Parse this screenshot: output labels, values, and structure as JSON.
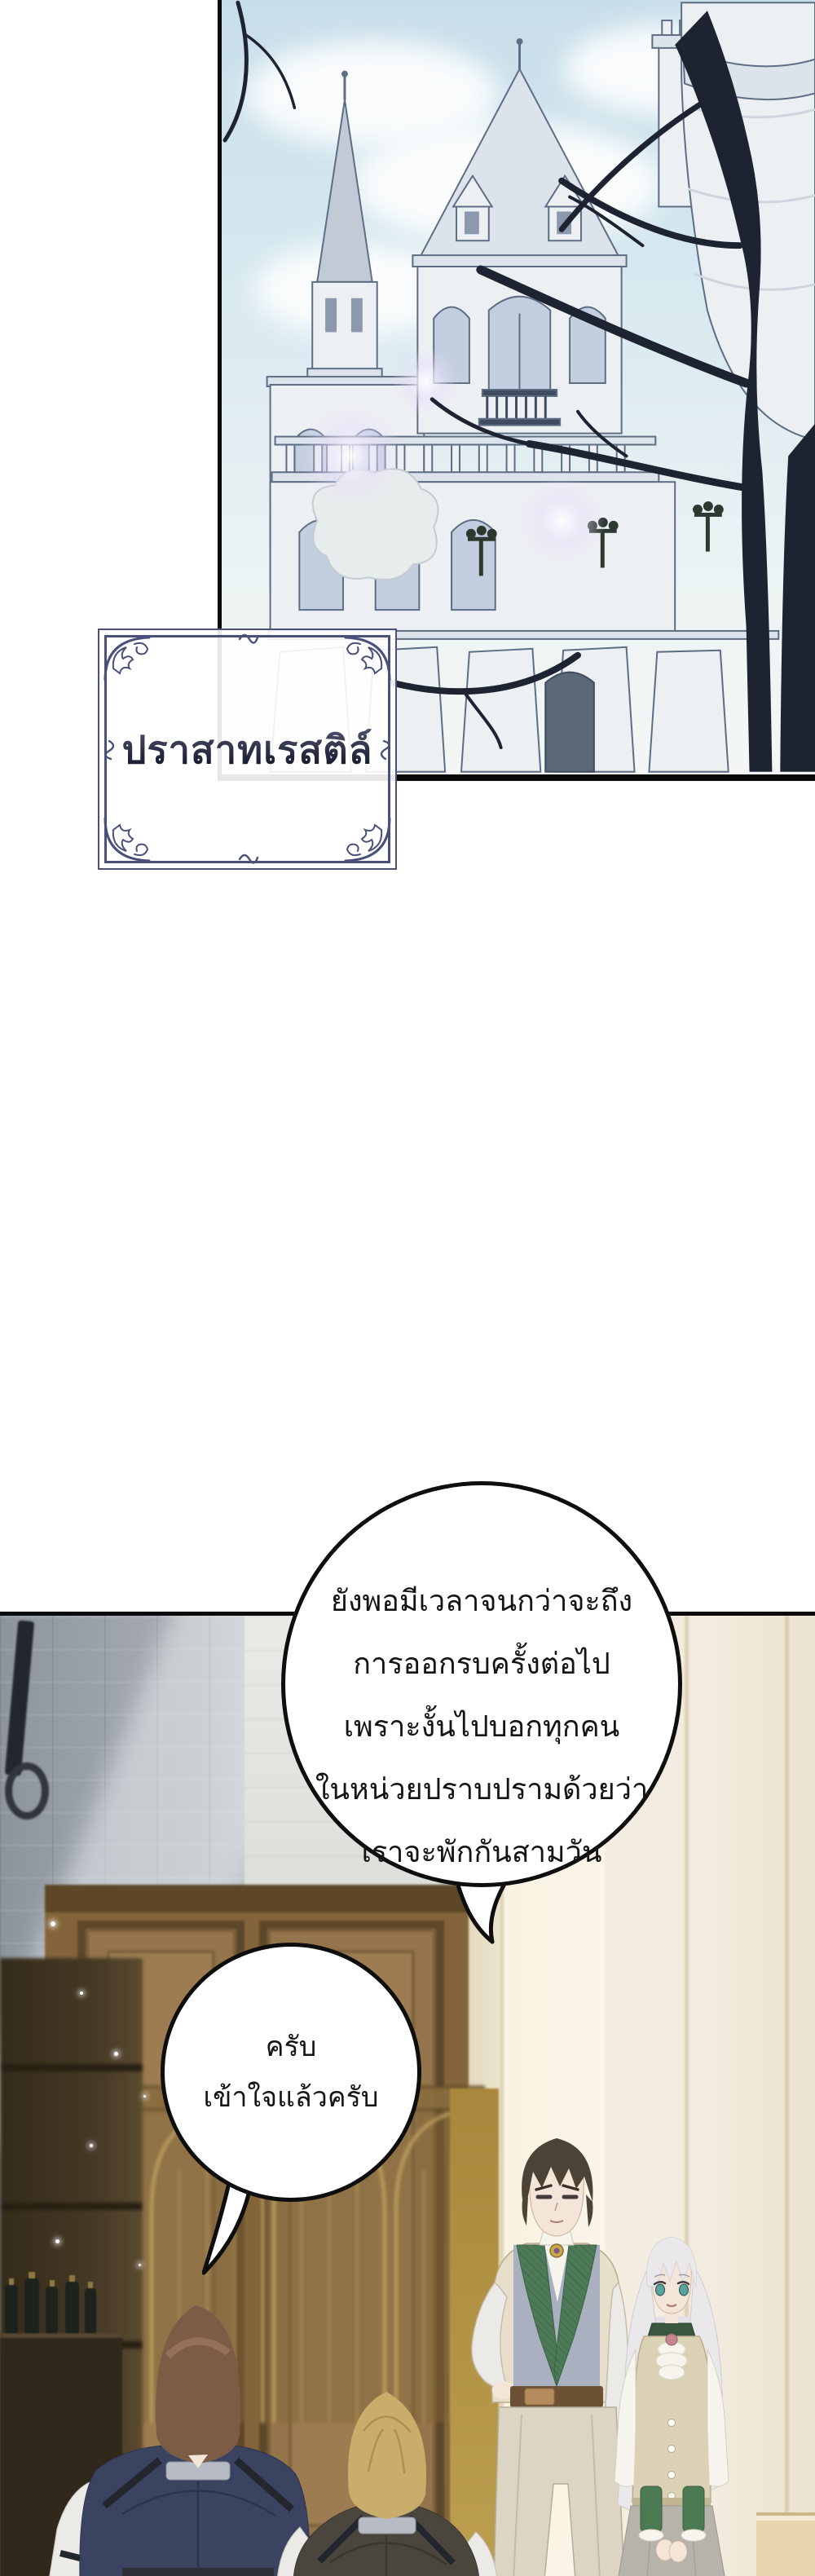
{
  "location_label": {
    "text": "ปราสาทเรสติล์"
  },
  "bubbles": {
    "narration": {
      "lines": [
        "ยังพอมีเวลาจนกว่าจะถึง",
        "การออกรบครั้งต่อไป",
        "เพราะงั้นไปบอกทุกคน",
        "ในหน่วยปราบปรามด้วยว่า",
        "เราจะพักกันสามวัน"
      ]
    },
    "reply": {
      "lines": [
        "ครับ",
        "เข้าใจแล้วครับ"
      ]
    }
  },
  "palette": {
    "ink": "#0b0b0b",
    "bubble_border": "#0e0e0e",
    "text": "#141414",
    "sky_top": "#c7dde9",
    "sky_mid": "#d5e8ef",
    "castle_line": "#5d6d84",
    "roof": "#c2cad6",
    "roof_light": "#dde3ea",
    "glass": "#c3cfe0",
    "window_dark": "#8c98ab",
    "branch": "#1d2330",
    "label_border": "#4a5178",
    "label_text_top": "#5a5f7a",
    "label_text_bot": "#15172a",
    "wall_gray": "#8d949c",
    "wood": "#84643a",
    "wood_dark": "#5e4729",
    "wood_panel": "#94744a",
    "gold": "#c4a666",
    "gold_dark": "#806538",
    "mustard": "#a8883c",
    "cream": "#efe7d2",
    "stone": "#f2ecdf",
    "stone_groove": "#c9ba96",
    "floor": "#e7d6ad",
    "furn": "#473a26",
    "furn_dark": "#352b1a",
    "skin": "#f3e6d8",
    "manA_hair": "#7d5c46",
    "manA_vest": "#3a4360",
    "manB_hair": "#c9ae6b",
    "manB_vest": "#4a453d",
    "sleeve": "#ebeae6",
    "collar_gray": "#b7bbc3",
    "strap": "#24262e",
    "manC_hair": "#4c4236",
    "vest_green": "#4d7a57",
    "vest_green_dark": "#3c6246",
    "waistcoat": "#a9b0bf",
    "jacket": "#e8dfca",
    "belt": "#6d5135",
    "buckle": "#b48c5c",
    "pants": "#dcd5c3",
    "woman_hair": "#eae8eb",
    "collar_green": "#3a573f",
    "vest_beige": "#dbd1b4",
    "skirt": "#b6b3ab",
    "cuff": "#4c7a52",
    "brooch": "#c5848e",
    "shirt": "#f7f4ee",
    "eye_teal": "#58a39b"
  }
}
